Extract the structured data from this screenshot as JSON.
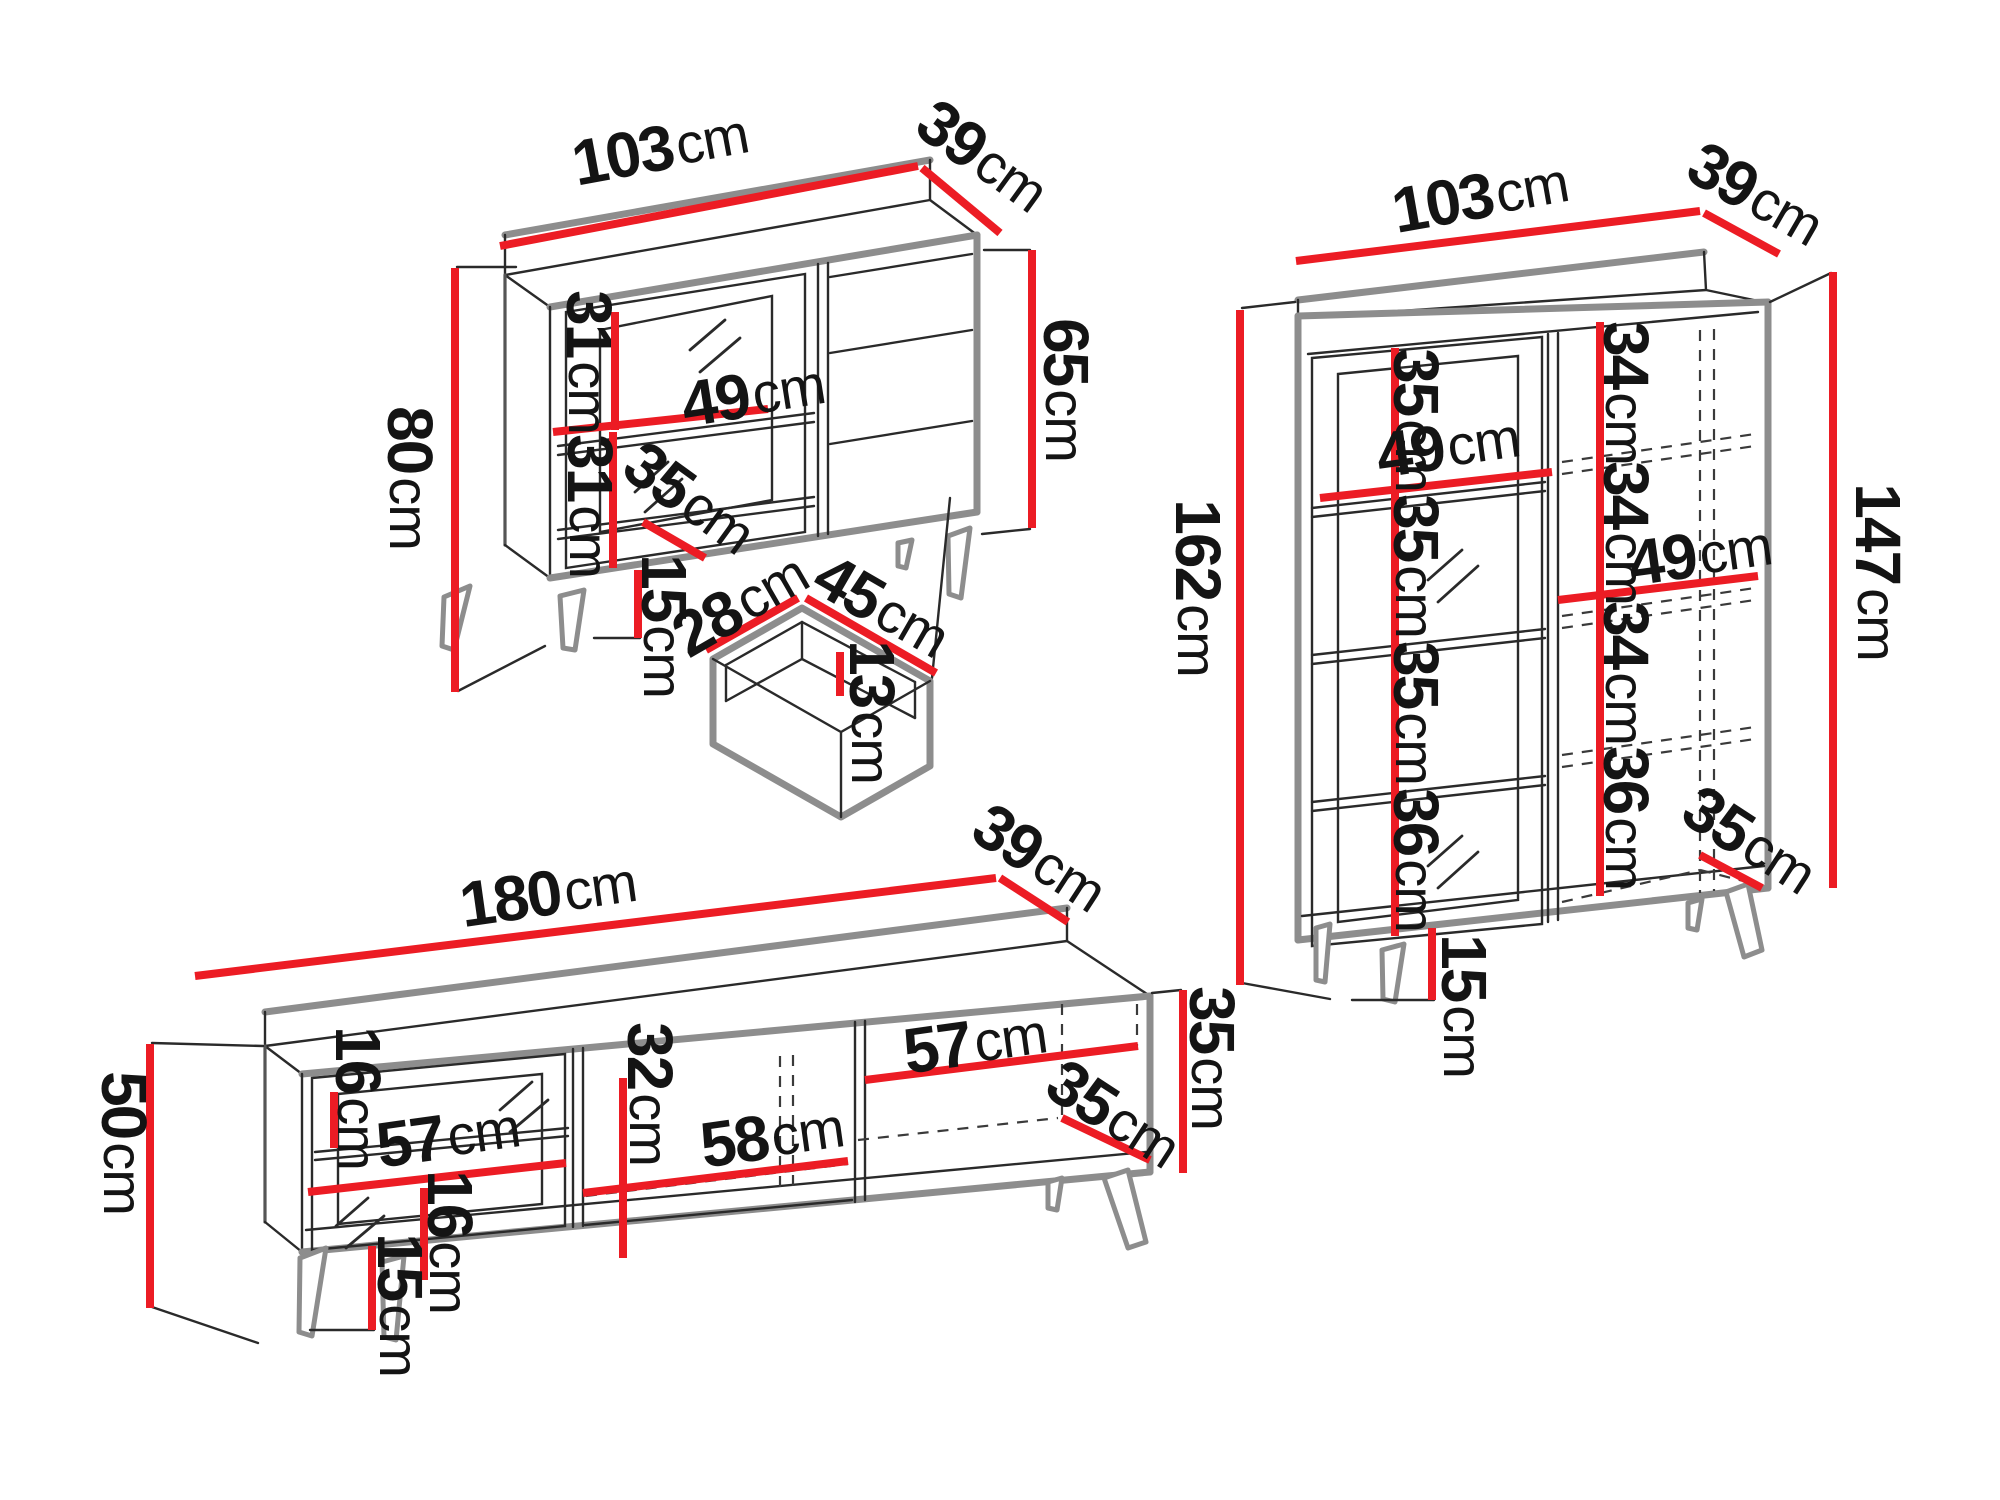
{
  "unit": "cm",
  "accent_color": "#ec1c24",
  "outline_color": "#8d8d8d",
  "sideboard": {
    "width": "103",
    "depth": "39",
    "height": "80",
    "body_height": "65",
    "top_section": "31",
    "shelf_width": "49",
    "bottom_section": "31",
    "inner_depth": "35",
    "leg_height": "15"
  },
  "drawer": {
    "depth": "28",
    "width": "45",
    "height": "13"
  },
  "display_cabinet": {
    "width": "103",
    "depth": "39",
    "height": "162",
    "body_height": "147",
    "left_sections": [
      "35",
      "35",
      "35",
      "36"
    ],
    "left_shelf_width": "49",
    "right_sections": [
      "34",
      "34",
      "34",
      "36"
    ],
    "right_shelf_width": "49",
    "inner_depth": "35",
    "leg_height": "15"
  },
  "tv_stand": {
    "width": "180",
    "depth": "39",
    "height": "50",
    "body_height": "35",
    "above_shelf": "16",
    "left_shelf_width": "57",
    "below_shelf": "16",
    "inner_height": "32",
    "middle_width": "58",
    "right_width": "57",
    "inner_depth": "35",
    "leg_height": "15"
  }
}
